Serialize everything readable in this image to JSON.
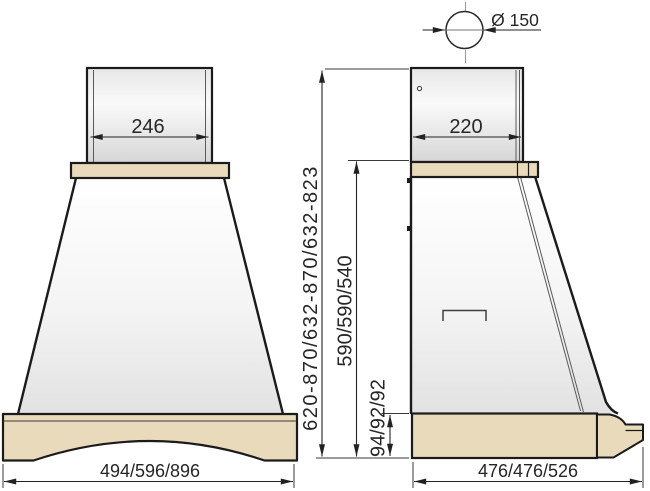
{
  "drawing": {
    "type": "cooker-hood dimension drawing, front and side views",
    "labels": {
      "duct_diameter": "Ø 150",
      "chimney_width_front": "246",
      "chimney_depth_side": "220",
      "total_height_range": "620-870/632-870/632-823",
      "hood_height_options": "590/590/540",
      "valance_height_options": "94/92/92",
      "width_options": "494/596/896",
      "depth_options": "476/476/526"
    },
    "colors": {
      "wood_trim": "#e9dabb",
      "outline": "#1b1b1b",
      "dimension_line": "#222222",
      "centerline": "#9a9a9a",
      "metal_gradient_top": "#e7e7e7",
      "metal_gradient_bottom": "#d6d6d6"
    }
  }
}
